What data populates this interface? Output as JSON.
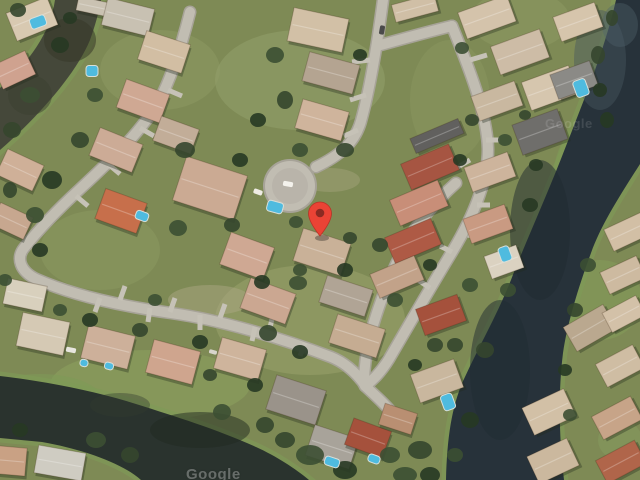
{
  "map": {
    "type": "satellite-imagery",
    "watermark_text": "Google",
    "marker": {
      "x": 320,
      "tip_y": 236,
      "r": 11.5,
      "color": "#EA4335",
      "dot_color": "#8A2A22"
    },
    "palette": {
      "grass_base": "#7e8a55",
      "street_edge": "#a7a398",
      "street_fill": "#c1bdb2",
      "street_inner": "#b5b1a6",
      "driveway": "#c6c2b7",
      "water_olive": "#45483a",
      "water_olive_dark": "#363928",
      "water_right": "#27323a",
      "water_right_light": "#46565f",
      "water_bottom": "#2a332e",
      "bank_green": "#7f9b57",
      "pool_blue": "#4fbbdf",
      "house_stroke": "rgba(60,40,20,0.25)",
      "shadow": "rgba(35,42,28,0.35)"
    },
    "water": [
      {
        "name": "top-left-canal",
        "c": "#45483a",
        "d": "M55,0 C50,34 29,62 0,88 L0,150 C38,117 76,74 90,40 C95,26 99,12 101,0 Z"
      },
      {
        "name": "right-canal",
        "c": "#27323a",
        "d": "M616,0 L640,0 L640,164 C619,197 601,225 591,253 C578,288 567,325 563,353 C558,393 559,437 564,480 L446,480 C447,437 452,405 464,379 C481,342 500,310 514,272 C531,230 550,188 566,146 C586,95 605,48 616,0 Z"
      },
      {
        "name": "bottom-left-lake",
        "c": "#2a332e",
        "d": "M0,376 C42,381 92,390 136,404 C177,417 216,429 256,447 C276,456 296,469 309,480 L141,480 C122,463 82,449 42,442 L0,438 Z"
      }
    ],
    "water_tints": [
      [
        70,
        40,
        26,
        22,
        "#363928",
        0.55
      ],
      [
        30,
        95,
        22,
        20,
        "#3c3f30",
        0.5
      ],
      [
        600,
        60,
        26,
        50,
        "#46565f",
        0.45
      ],
      [
        620,
        25,
        18,
        22,
        "#51616b",
        0.4
      ],
      [
        540,
        230,
        30,
        70,
        "#1f2930",
        0.5
      ],
      [
        500,
        370,
        30,
        70,
        "#202b31",
        0.5
      ],
      [
        200,
        430,
        50,
        18,
        "#20291f",
        0.5
      ],
      [
        120,
        405,
        30,
        12,
        "#333c30",
        0.4
      ]
    ],
    "grass_patches": [
      [
        300,
        80,
        85,
        50,
        "#9aa873",
        0.4
      ],
      [
        160,
        70,
        60,
        40,
        "#96a06b",
        0.35
      ],
      [
        310,
        320,
        95,
        55,
        "#9fa671",
        0.45
      ],
      [
        150,
        385,
        100,
        35,
        "#8da35f",
        0.5
      ],
      [
        580,
        190,
        28,
        62,
        "#7f9b57",
        0.55
      ],
      [
        600,
        300,
        42,
        40,
        "#86a05c",
        0.45
      ],
      [
        100,
        250,
        60,
        40,
        "#93a068",
        0.35
      ],
      [
        480,
        430,
        30,
        25,
        "#7e975a",
        0.5
      ],
      [
        40,
        400,
        62,
        26,
        "#7e9a58",
        0.55
      ],
      [
        520,
        20,
        50,
        30,
        "#96a06b",
        0.35
      ],
      [
        620,
        440,
        22,
        20,
        "#8aa061",
        0.4
      ],
      [
        210,
        300,
        42,
        15,
        "#b0a887",
        0.45
      ],
      [
        330,
        180,
        30,
        12,
        "#b3ab8a",
        0.35
      ],
      [
        450,
        100,
        40,
        60,
        "#93a068",
        0.3
      ]
    ],
    "streets": [
      "M383,0 C377,46 369,92 361,121 C355,143 339,156 316,167",
      "M377,46 C402,39 427,32 452,26",
      "M452,26 C470,70 487,114 488,149 C488,184 470,222 452,252 C430,288 406,330 389,359 C381,372 372,381 365,386",
      "M456,183 C436,201 420,219 408,241 C392,269 378,306 370,336 C366,353 364,369 364,384",
      "M190,12 C181,48 170,81 158,103 C140,133 110,161 80,189 C56,211 36,233 24,248 C16,258 20,271 36,279 C72,295 121,306 171,313 C221,320 281,338 331,357 C346,363 357,374 365,385",
      "M365,386 C377,397 389,408 397,419"
    ],
    "cul_de_sac": {
      "x": 290,
      "y": 186,
      "r": 27
    },
    "driveways": [
      [
        470,
        60,
        487,
        55
      ],
      [
        480,
        100,
        497,
        95
      ],
      [
        486,
        140,
        500,
        140
      ],
      [
        477,
        205,
        490,
        205
      ],
      [
        468,
        235,
        482,
        238
      ],
      [
        470,
        160,
        456,
        168
      ],
      [
        452,
        252,
        440,
        246
      ],
      [
        430,
        288,
        418,
        280
      ],
      [
        370,
        60,
        352,
        62
      ],
      [
        366,
        95,
        350,
        100
      ],
      [
        358,
        130,
        344,
        136
      ],
      [
        120,
        300,
        125,
        286
      ],
      [
        170,
        312,
        175,
        298
      ],
      [
        220,
        318,
        225,
        304
      ],
      [
        270,
        328,
        273,
        314
      ],
      [
        100,
        298,
        95,
        312
      ],
      [
        150,
        308,
        148,
        322
      ],
      [
        200,
        315,
        200,
        330
      ],
      [
        255,
        327,
        252,
        341
      ],
      [
        305,
        343,
        300,
        356
      ],
      [
        168,
        90,
        182,
        96
      ],
      [
        140,
        128,
        154,
        136
      ],
      [
        108,
        164,
        120,
        174
      ],
      [
        76,
        196,
        88,
        206
      ]
    ],
    "houses": [
      [
        32,
        19,
        44,
        30,
        -22,
        "#d8c9b1"
      ],
      [
        14,
        70,
        36,
        26,
        -25,
        "#cfa28f"
      ],
      [
        95,
        7,
        36,
        14,
        12,
        "#cac2b2"
      ],
      [
        128,
        17,
        48,
        28,
        14,
        "#c8c1b2"
      ],
      [
        164,
        52,
        46,
        30,
        18,
        "#d2bea3"
      ],
      [
        143,
        101,
        46,
        30,
        20,
        "#cfa893"
      ],
      [
        116,
        150,
        46,
        30,
        22,
        "#ccab96"
      ],
      [
        176,
        135,
        40,
        26,
        20,
        "#c2ad98"
      ],
      [
        121,
        211,
        44,
        32,
        20,
        "#c76f4b"
      ],
      [
        210,
        188,
        64,
        46,
        18,
        "#cbaa93"
      ],
      [
        247,
        256,
        46,
        34,
        20,
        "#cfa893"
      ],
      [
        318,
        30,
        56,
        34,
        12,
        "#d2c0a6"
      ],
      [
        331,
        73,
        52,
        30,
        15,
        "#b4a491"
      ],
      [
        322,
        120,
        48,
        30,
        16,
        "#cfb49c"
      ],
      [
        322,
        252,
        50,
        34,
        18,
        "#c9b198"
      ],
      [
        268,
        301,
        48,
        32,
        20,
        "#cba791"
      ],
      [
        346,
        296,
        48,
        28,
        18,
        "#b0a495"
      ],
      [
        357,
        336,
        50,
        30,
        18,
        "#c5ac92"
      ],
      [
        437,
        136,
        52,
        16,
        -23,
        "#61605e"
      ],
      [
        430,
        167,
        52,
        28,
        -23,
        "#a65542"
      ],
      [
        419,
        203,
        52,
        28,
        -23,
        "#c88e78"
      ],
      [
        413,
        241,
        50,
        28,
        -23,
        "#ae5a45"
      ],
      [
        397,
        277,
        48,
        26,
        -23,
        "#c2a289"
      ],
      [
        415,
        8,
        44,
        18,
        -15,
        "#d0bfa6"
      ],
      [
        487,
        17,
        52,
        28,
        -20,
        "#d4c3ab"
      ],
      [
        520,
        52,
        52,
        30,
        -20,
        "#cdbca6"
      ],
      [
        550,
        88,
        50,
        30,
        -20,
        "#d6c6ae"
      ],
      [
        540,
        132,
        48,
        32,
        -20,
        "#6f6e6b"
      ],
      [
        497,
        101,
        46,
        26,
        -20,
        "#c9b8a0"
      ],
      [
        490,
        172,
        46,
        26,
        -20,
        "#cdb49c"
      ],
      [
        488,
        224,
        44,
        26,
        -20,
        "#c99a82"
      ],
      [
        504,
        262,
        34,
        24,
        -20,
        "#dbd2c1"
      ],
      [
        441,
        315,
        44,
        28,
        -20,
        "#a5513c"
      ],
      [
        437,
        381,
        46,
        30,
        -20,
        "#c9b79e"
      ],
      [
        20,
        170,
        40,
        28,
        25,
        "#cfb098"
      ],
      [
        12,
        221,
        36,
        24,
        25,
        "#c7a78f"
      ],
      [
        25,
        295,
        40,
        26,
        12,
        "#d8d0bd"
      ],
      [
        43,
        334,
        48,
        34,
        12,
        "#d5c9b4"
      ],
      [
        108,
        347,
        48,
        34,
        14,
        "#cdb09a"
      ],
      [
        173,
        362,
        48,
        34,
        15,
        "#cfa58e"
      ],
      [
        240,
        359,
        46,
        32,
        16,
        "#ceb49c"
      ],
      [
        296,
        400,
        52,
        36,
        18,
        "#9a938a"
      ],
      [
        332,
        447,
        46,
        32,
        18,
        "#a8a39a"
      ],
      [
        368,
        438,
        40,
        28,
        20,
        "#a5513c"
      ],
      [
        398,
        419,
        34,
        22,
        18,
        "#b98f72"
      ],
      [
        60,
        463,
        48,
        28,
        10,
        "#cfccc2"
      ],
      [
        12,
        461,
        28,
        28,
        5,
        "#c9a184"
      ],
      [
        578,
        22,
        44,
        26,
        -20,
        "#d6c5ac"
      ],
      [
        574,
        80,
        42,
        26,
        -20,
        "#8b8a86"
      ],
      [
        627,
        232,
        40,
        24,
        -25,
        "#d2bfa5"
      ],
      [
        623,
        275,
        40,
        24,
        -25,
        "#cdbaa0"
      ],
      [
        590,
        328,
        46,
        28,
        -30,
        "#baa88f"
      ],
      [
        624,
        314,
        38,
        22,
        -28,
        "#d3c1a8"
      ],
      [
        620,
        366,
        42,
        26,
        -28,
        "#cfbda3"
      ],
      [
        617,
        418,
        44,
        26,
        -28,
        "#c7a488"
      ],
      [
        621,
        462,
        44,
        26,
        -28,
        "#b0654a"
      ],
      [
        549,
        412,
        46,
        30,
        -25,
        "#d2c0a6"
      ],
      [
        553,
        461,
        44,
        30,
        -25,
        "#cbb89e"
      ]
    ],
    "trees": [
      [
        18,
        10,
        8,
        7
      ],
      [
        60,
        45,
        9,
        8
      ],
      [
        30,
        95,
        10,
        8
      ],
      [
        12,
        130,
        9,
        8
      ],
      [
        70,
        18,
        7,
        6
      ],
      [
        95,
        95,
        8,
        7
      ],
      [
        80,
        140,
        9,
        8
      ],
      [
        52,
        180,
        10,
        9
      ],
      [
        35,
        215,
        9,
        8
      ],
      [
        10,
        190,
        7,
        8
      ],
      [
        40,
        250,
        8,
        7
      ],
      [
        5,
        280,
        7,
        6
      ],
      [
        185,
        150,
        10,
        8
      ],
      [
        240,
        160,
        8,
        7
      ],
      [
        178,
        228,
        9,
        8
      ],
      [
        232,
        225,
        8,
        7
      ],
      [
        262,
        282,
        8,
        7
      ],
      [
        298,
        283,
        9,
        7
      ],
      [
        268,
        333,
        9,
        8
      ],
      [
        300,
        352,
        8,
        7
      ],
      [
        275,
        55,
        9,
        8
      ],
      [
        285,
        100,
        8,
        9
      ],
      [
        360,
        55,
        7,
        6
      ],
      [
        300,
        150,
        8,
        7
      ],
      [
        345,
        150,
        9,
        7
      ],
      [
        258,
        120,
        8,
        7
      ],
      [
        296,
        222,
        7,
        6
      ],
      [
        350,
        238,
        7,
        6
      ],
      [
        345,
        270,
        8,
        7
      ],
      [
        300,
        270,
        7,
        6
      ],
      [
        380,
        245,
        8,
        7
      ],
      [
        430,
        265,
        7,
        6
      ],
      [
        395,
        300,
        8,
        7
      ],
      [
        435,
        345,
        8,
        7
      ],
      [
        415,
        365,
        7,
        6
      ],
      [
        462,
        48,
        7,
        6
      ],
      [
        472,
        120,
        7,
        6
      ],
      [
        460,
        160,
        7,
        6
      ],
      [
        505,
        140,
        7,
        6
      ],
      [
        525,
        115,
        6,
        5
      ],
      [
        536,
        165,
        7,
        6
      ],
      [
        470,
        285,
        8,
        7
      ],
      [
        455,
        345,
        8,
        7
      ],
      [
        530,
        205,
        8,
        7
      ],
      [
        508,
        290,
        8,
        7
      ],
      [
        485,
        350,
        9,
        8
      ],
      [
        470,
        420,
        9,
        8
      ],
      [
        455,
        455,
        8,
        7
      ],
      [
        598,
        55,
        7,
        9
      ],
      [
        607,
        120,
        7,
        8
      ],
      [
        588,
        265,
        8,
        7
      ],
      [
        575,
        310,
        8,
        7
      ],
      [
        565,
        370,
        7,
        6
      ],
      [
        570,
        415,
        7,
        6
      ],
      [
        612,
        18,
        6,
        8
      ],
      [
        600,
        90,
        7,
        7
      ],
      [
        310,
        455,
        14,
        10
      ],
      [
        285,
        440,
        10,
        8
      ],
      [
        345,
        470,
        12,
        9
      ],
      [
        390,
        455,
        10,
        8
      ],
      [
        420,
        450,
        12,
        9
      ],
      [
        430,
        475,
        10,
        8
      ],
      [
        405,
        475,
        12,
        8
      ],
      [
        265,
        425,
        9,
        8
      ],
      [
        90,
        320,
        8,
        7
      ],
      [
        60,
        310,
        7,
        6
      ],
      [
        140,
        330,
        8,
        7
      ],
      [
        200,
        342,
        8,
        7
      ],
      [
        96,
        440,
        10,
        8
      ],
      [
        130,
        455,
        9,
        8
      ],
      [
        20,
        430,
        8,
        7
      ],
      [
        155,
        300,
        7,
        6
      ],
      [
        210,
        375,
        7,
        6
      ],
      [
        255,
        385,
        8,
        7
      ],
      [
        222,
        412,
        9,
        8
      ]
    ],
    "tree_colors": [
      "#35462e",
      "#273823",
      "#3c4f33"
    ],
    "pools": [
      [
        38,
        22,
        16,
        11,
        -20
      ],
      [
        92,
        71,
        12,
        11,
        0
      ],
      [
        275,
        207,
        16,
        11,
        15
      ],
      [
        142,
        216,
        13,
        9,
        20
      ],
      [
        581,
        88,
        13,
        17,
        -20
      ],
      [
        505,
        254,
        11,
        15,
        -20
      ],
      [
        448,
        402,
        12,
        16,
        -20
      ],
      [
        332,
        462,
        15,
        9,
        18
      ],
      [
        374,
        459,
        12,
        8,
        20
      ],
      [
        109,
        366,
        9,
        7,
        14
      ],
      [
        84,
        363,
        8,
        7,
        12
      ]
    ],
    "vehicles": [
      [
        288,
        184,
        10,
        5,
        10,
        "#f4f2ec"
      ],
      [
        382,
        30,
        5,
        9,
        10,
        "#4a4a4a"
      ],
      [
        258,
        192,
        9,
        5,
        20,
        "#efece4"
      ],
      [
        71,
        350,
        10,
        5,
        12,
        "#e8e6df"
      ],
      [
        213,
        352,
        8,
        4,
        15,
        "#d8d5cc"
      ]
    ]
  }
}
